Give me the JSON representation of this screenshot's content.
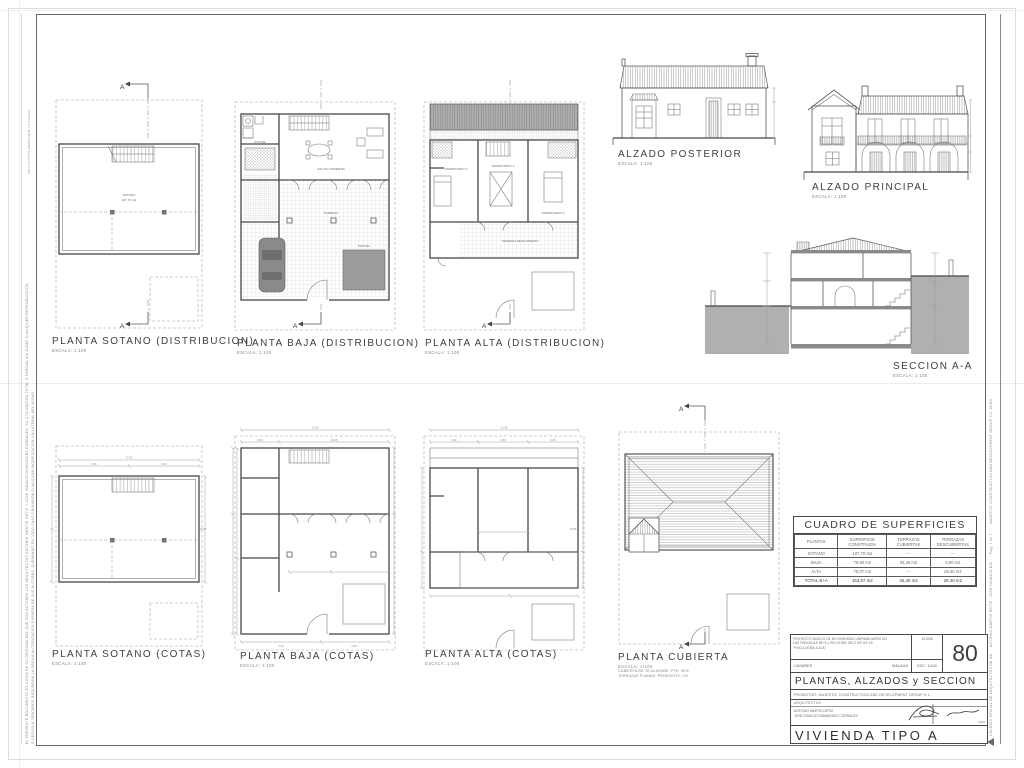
{
  "palette": {
    "line": "#474747",
    "earth": "#b0b0b0",
    "pool": "#9c9c9c",
    "car": "#8a8a8a"
  },
  "margins": {
    "left_code": "08L2-42/T705-0929Z/URN-LU/TU2/A3",
    "left_disclaimer_1": "EL PRESENTE DOCUMENTO ES COPIA DE SU ORIGINAL DEL QUE SON AUTORES LOS ARQUITECTOS ANTONIO MARTIN ORTIZ Y JOSE IGNACIO DOMINGUEZ CORRALES, SU UTILIZACION TOTAL O PARCIAL ASI COMO CUALQUIER REPRODUCCION",
    "left_disclaimer_2": "O CESION A TERCEROS REQUERIRA LA PREVIA AUTORIZACION EXPRESA DE SUS AUTORES, QUEDANDO EN TODO CASO PROHIBIDA CUALQUIER MODIFICACION UNILATERAL DEL MISMO",
    "right_company": "MAJESTIC CONSTRUCTION AND DEVELOPMENT GROUP S.L.  AVENIDA RICARDO SORIANO, MARBELLA  (MALAGA)",
    "right_page": "Pag. 1 de 7",
    "right_architects": "ANTONIO MARTIN ORTIZ  .  JOSE IGNACIO DOMINGUEZ CORRALES  .  ARQUITECTOS",
    "right_colegio": "COLEGIO OFICIAL DE ARQUITECTOS DE MALAGA  .  VISADO  .  05GB  .  2006"
  },
  "plans": [
    {
      "label": "PLANTA SOTANO (DISTRIBUCION)",
      "scale": "ESCALA: 1:100"
    },
    {
      "label": "PLANTA BAJA (DISTRIBUCION)",
      "scale": "ESCALA: 1:100"
    },
    {
      "label": "PLANTA ALTA (DISTRIBUCION)",
      "scale": "ESCALA: 1:100"
    },
    {
      "label": "ALZADO POSTERIOR",
      "scale": "ESCALA: 1:100"
    },
    {
      "label": "ALZADO PRINCIPAL",
      "scale": "ESCALA: 1:100"
    },
    {
      "label": "SECCION A-A",
      "scale": "ESCALA: 1:100"
    },
    {
      "label": "PLANTA SOTANO (COTAS)",
      "scale": "ESCALA: 1:100"
    },
    {
      "label": "PLANTA BAJA (COTAS)",
      "scale": "ESCALA: 1:100"
    },
    {
      "label": "PLANTA ALTA (COTAS)",
      "scale": "ESCALA: 1:100"
    },
    {
      "label": "PLANTA CUBIERTA",
      "scale": "ESCALA: 1/100",
      "note1": "CUBIERTA DE TEJA ARABE, PTE: 50%",
      "note2": "TERRAZAS PLANAS,  PENDIENTE: 2%"
    }
  ],
  "markers": {
    "section": "A"
  },
  "rooms": {
    "sotano": "SOTANO",
    "sotano_area": "107,70 m2",
    "salon": "SALON COMEDOR",
    "cocina": "COCINA",
    "terraza": "TERRAZA",
    "piscina": "PISCINA",
    "dorm1": "DORMITORIO 1",
    "dorm2": "DORMITORIO 2",
    "dorm3": "DORMITORIO 3",
    "terraza_desc": "TERRAZA DESCUBIERTA"
  },
  "dims": {
    "a": "12,95",
    "b": "10,65",
    "c": "4,90",
    "d": "3,80",
    "e": "2,60",
    "f": "6,45"
  },
  "table": {
    "title": "CUADRO DE SUPERFICIES",
    "headers": [
      "PLANTAS",
      "SUPERFICIE CONSTRUIDA",
      "TERRAZAS CUBIERTAS",
      "TERRAZAS DESCUBIERTAS"
    ],
    "rows": [
      [
        "SOTANO",
        "107,70 m2",
        "---",
        "---"
      ],
      [
        "BAJA",
        "78,80 m2",
        "26,40 m2",
        "3,00 m2"
      ],
      [
        "ALTA",
        "75,07 m2",
        "---",
        "26,40 m2"
      ],
      [
        "TOTAL B+A",
        "153,87 m2",
        "26,40 m2",
        "29,40 m2"
      ]
    ]
  },
  "titleblock": {
    "project_line1": "PROYECTO BASICO DE 83 VIVIENDAS UNIFAMILIARES EN",
    "project_line2": "LAS PARCELAS RE-9 y RE-10 DEL SECTOR UR-15",
    "project_line3": "\"FINCA DOÑA JULIA\"",
    "date": "121006",
    "municipality": "CASARES",
    "province": "MALAGA",
    "scale": "ESC. 1/100",
    "sheet_number": "80",
    "sheet_title": "PLANTAS, ALZADOS y SECCION",
    "promoter": "PROMOTOR: MAJESTIC CONSTRUCTION AND DEVELOPMENT GROUP S.L.",
    "architects_label": "ARQUITECTOS",
    "architect_1": "ANTONIO MARTIN ORTIZ",
    "architect_2": "JOSE IGNACIO DOMINGUEZ CORRALES",
    "code": "0508",
    "dwelling_title": "VIVIENDA TIPO A"
  }
}
